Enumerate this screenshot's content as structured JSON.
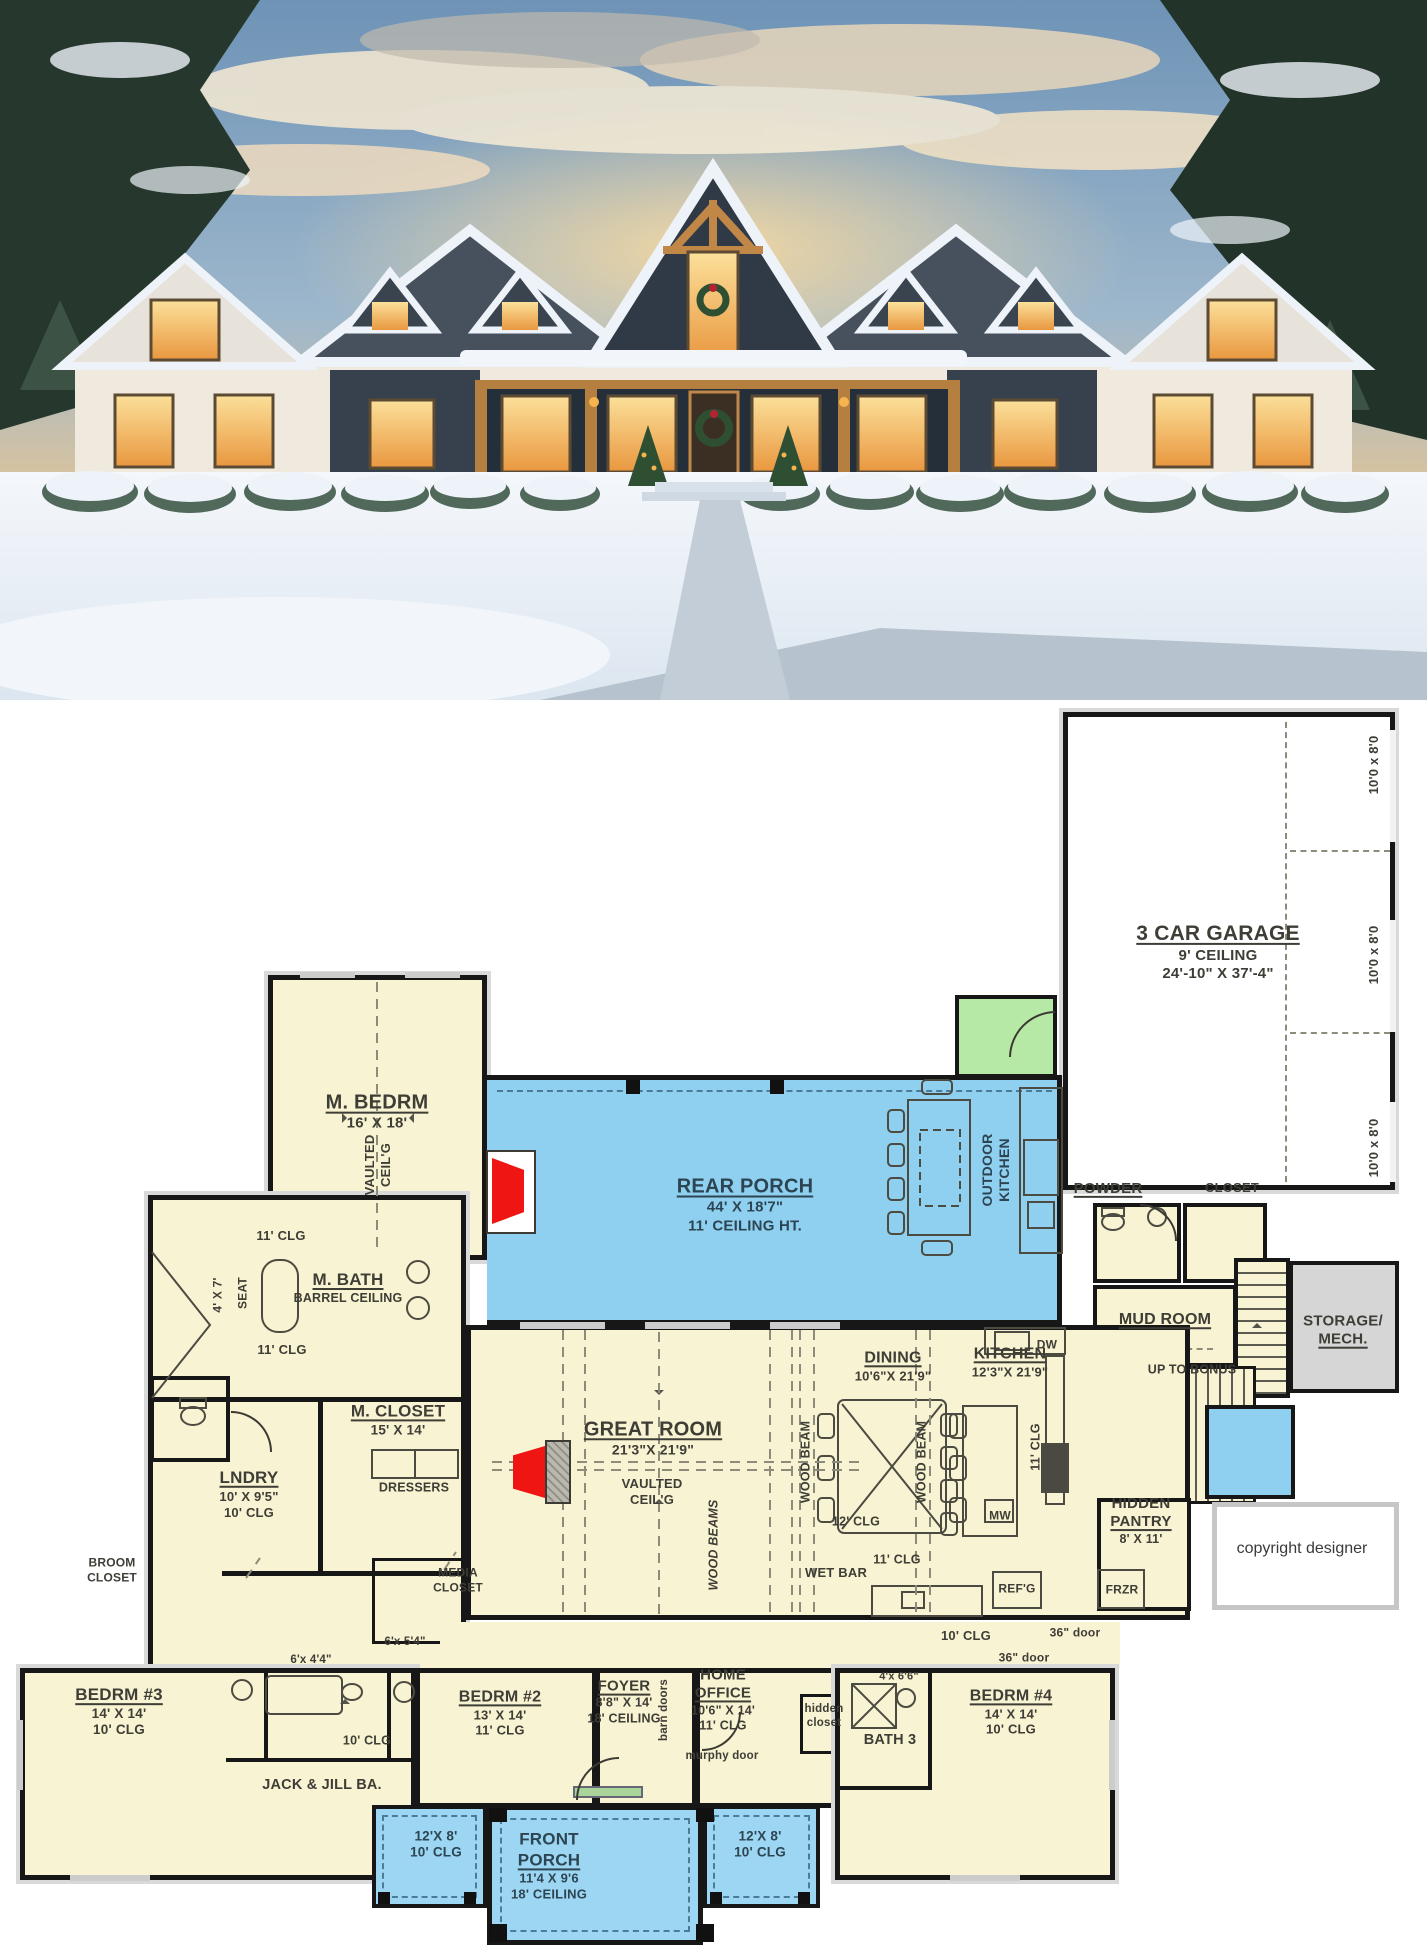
{
  "photo": {
    "description": "Snow-covered modern farmhouse at dusk, warm lit windows, wreaths on door, snowy trees and shrubs",
    "colors": {
      "sky_top": "#6e93b6",
      "sky_glow": "#f0cb90",
      "cloud": "#f6ead2",
      "roof": "#46515d",
      "dark_siding": "#36414d",
      "wall": "#efe9de",
      "timber": "#b5803f",
      "window_glow": "#f6b44e",
      "snow": "#eef3f9",
      "tree": "#26382d",
      "wreath": "#2f4f33",
      "bow": "#b32430"
    }
  },
  "plan": {
    "colors": {
      "room_fill": "#f8f3d2",
      "porch_fill": "#8fd0f1",
      "front_porch_fill": "#9cd6f3",
      "vestibule_green": "#b6e8a6",
      "storage_gray": "#d6d6d6",
      "wall": "#171717",
      "ink": "#3e3d36",
      "porch_ink": "#2d4552",
      "fireplace_red": "#ee1512"
    },
    "labels": [
      {
        "id": "garage-title",
        "x": 1218,
        "y": 952,
        "lines": [
          {
            "t": "3 CAR GARAGE",
            "s": 21,
            "u": 1
          },
          {
            "t": "9' CEILING",
            "s": 15
          },
          {
            "t": "24'-10\" X 37'-4\"",
            "s": 15
          }
        ]
      },
      {
        "id": "garage-door-1",
        "x": 1374,
        "y": 765,
        "rot": -90,
        "lines": [
          {
            "t": "10'0 x 8'0",
            "s": 13
          }
        ]
      },
      {
        "id": "garage-door-2",
        "x": 1374,
        "y": 955,
        "rot": -90,
        "lines": [
          {
            "t": "10'0 x 8'0",
            "s": 13
          }
        ]
      },
      {
        "id": "garage-door-3",
        "x": 1374,
        "y": 1148,
        "rot": -90,
        "lines": [
          {
            "t": "10'0 x 8'0",
            "s": 13
          }
        ]
      },
      {
        "id": "m-bedrm",
        "x": 377,
        "y": 1112,
        "lines": [
          {
            "t": "M. BEDRM",
            "s": 20,
            "u": 1
          },
          {
            "t": "16' X 18'",
            "s": 15
          }
        ]
      },
      {
        "id": "m-bedrm-vaulted",
        "x": 378,
        "y": 1165,
        "rot": -90,
        "lines": [
          {
            "t": "VAULTED",
            "s": 13
          },
          {
            "t": "CEIL'G",
            "s": 13
          }
        ]
      },
      {
        "id": "rear-porch",
        "x": 745,
        "y": 1205,
        "color": "#2d4552",
        "lines": [
          {
            "t": "REAR PORCH",
            "s": 20,
            "u": 1
          },
          {
            "t": "44' X 18'7\"",
            "s": 15
          },
          {
            "t": "11' CEILING HT.",
            "s": 15
          }
        ]
      },
      {
        "id": "outdoor-kitchen",
        "x": 996,
        "y": 1170,
        "rot": -90,
        "color": "#2d4552",
        "lines": [
          {
            "t": "OUTDOOR",
            "s": 14
          },
          {
            "t": "KITCHEN",
            "s": 14
          }
        ]
      },
      {
        "id": "powder",
        "x": 1108,
        "y": 1189,
        "lines": [
          {
            "t": "POWDER",
            "s": 15,
            "u": 1
          }
        ]
      },
      {
        "id": "closet-stairs",
        "x": 1232,
        "y": 1188,
        "lines": [
          {
            "t": "CLOSET",
            "s": 13
          }
        ]
      },
      {
        "id": "mud-room",
        "x": 1165,
        "y": 1320,
        "lines": [
          {
            "t": "MUD ROOM",
            "s": 16,
            "u": 1
          }
        ]
      },
      {
        "id": "up-to-bonus",
        "x": 1192,
        "y": 1370,
        "lines": [
          {
            "t": "UP TO BONUS",
            "s": 12.5
          }
        ]
      },
      {
        "id": "storage-mech",
        "x": 1343,
        "y": 1331,
        "lines": [
          {
            "t": "STORAGE/",
            "s": 15
          },
          {
            "t": "MECH.",
            "s": 15,
            "u": 1
          }
        ]
      },
      {
        "id": "m-bath",
        "x": 348,
        "y": 1288,
        "lines": [
          {
            "t": "M. BATH",
            "s": 17,
            "u": 1
          },
          {
            "t": "BARREL CEILING",
            "s": 12.5
          }
        ]
      },
      {
        "id": "clg-mbath-1",
        "x": 281,
        "y": 1236,
        "lines": [
          {
            "t": "11' CLG",
            "s": 13
          }
        ]
      },
      {
        "id": "clg-mbath-2",
        "x": 282,
        "y": 1350,
        "lines": [
          {
            "t": "11' CLG",
            "s": 13
          }
        ]
      },
      {
        "id": "seat",
        "x": 243,
        "y": 1293,
        "rot": -90,
        "lines": [
          {
            "t": "SEAT",
            "s": 12
          }
        ]
      },
      {
        "id": "dim-4x7",
        "x": 218,
        "y": 1295,
        "rot": -90,
        "lines": [
          {
            "t": "4' X 7'",
            "s": 12
          }
        ]
      },
      {
        "id": "m-closet",
        "x": 398,
        "y": 1420,
        "lines": [
          {
            "t": "M. CLOSET",
            "s": 17,
            "u": 1
          },
          {
            "t": "15' X 14'",
            "s": 13.5
          }
        ]
      },
      {
        "id": "dressers",
        "x": 414,
        "y": 1488,
        "lines": [
          {
            "t": "DRESSERS",
            "s": 12.5
          }
        ]
      },
      {
        "id": "lndry",
        "x": 249,
        "y": 1494,
        "lines": [
          {
            "t": "LNDRY",
            "s": 17,
            "u": 1
          },
          {
            "t": "10' X 9'5\"",
            "s": 13
          },
          {
            "t": "10' CLG",
            "s": 13
          }
        ]
      },
      {
        "id": "broom-closet",
        "x": 112,
        "y": 1570,
        "lines": [
          {
            "t": "BROOM",
            "s": 12
          },
          {
            "t": "CLOSET",
            "s": 12
          }
        ]
      },
      {
        "id": "media-closet",
        "x": 458,
        "y": 1580,
        "lines": [
          {
            "t": "MEDIA",
            "s": 12
          },
          {
            "t": "CLOSET",
            "s": 12
          }
        ]
      },
      {
        "id": "great-room",
        "x": 653,
        "y": 1438,
        "lines": [
          {
            "t": "GREAT ROOM",
            "s": 20,
            "u": 1
          },
          {
            "t": "21'3\"X 21'9\"",
            "s": 14
          }
        ]
      },
      {
        "id": "great-vaulted",
        "x": 652,
        "y": 1492,
        "lines": [
          {
            "t": "VAULTED",
            "s": 13
          },
          {
            "t": "CEIL'G",
            "s": 13
          }
        ]
      },
      {
        "id": "wood-beams",
        "x": 714,
        "y": 1545,
        "rot": -90,
        "italic": 1,
        "lines": [
          {
            "t": "WOOD BEAMS",
            "s": 12.5
          }
        ]
      },
      {
        "id": "wood-beam-l",
        "x": 806,
        "y": 1462,
        "rot": -90,
        "lines": [
          {
            "t": "WOOD BEAM",
            "s": 12.5
          }
        ]
      },
      {
        "id": "wood-beam-r",
        "x": 922,
        "y": 1462,
        "rot": -90,
        "lines": [
          {
            "t": "WOOD BEAM",
            "s": 12.5
          }
        ]
      },
      {
        "id": "dining",
        "x": 893,
        "y": 1366,
        "lines": [
          {
            "t": "DINING",
            "s": 16,
            "u": 1
          },
          {
            "t": "10'6\"X 21'9\"",
            "s": 13
          }
        ]
      },
      {
        "id": "clg-12",
        "x": 856,
        "y": 1522,
        "lines": [
          {
            "t": "12' CLG",
            "s": 12.5
          }
        ]
      },
      {
        "id": "clg-11-dining",
        "x": 897,
        "y": 1560,
        "lines": [
          {
            "t": "11' CLG",
            "s": 12.5
          }
        ]
      },
      {
        "id": "wet-bar",
        "x": 836,
        "y": 1573,
        "lines": [
          {
            "t": "WET BAR",
            "s": 13
          }
        ]
      },
      {
        "id": "kitchen",
        "x": 1010,
        "y": 1362,
        "lines": [
          {
            "t": "KITCHEN",
            "s": 16,
            "u": 1
          },
          {
            "t": "12'3\"X 21'9\"",
            "s": 13
          }
        ]
      },
      {
        "id": "clg-11-kitchen",
        "x": 1036,
        "y": 1447,
        "rot": -90,
        "lines": [
          {
            "t": "11' CLG",
            "s": 12.5
          }
        ]
      },
      {
        "id": "mw",
        "x": 1000,
        "y": 1516,
        "lines": [
          {
            "t": "MW",
            "s": 12
          }
        ]
      },
      {
        "id": "refg",
        "x": 1017,
        "y": 1589,
        "lines": [
          {
            "t": "REF'G",
            "s": 12
          }
        ]
      },
      {
        "id": "dw",
        "x": 1047,
        "y": 1345,
        "lines": [
          {
            "t": "DW",
            "s": 12
          }
        ]
      },
      {
        "id": "hidden-pantry",
        "x": 1141,
        "y": 1521,
        "lines": [
          {
            "t": "HIDDEN",
            "s": 15
          },
          {
            "t": "PANTRY",
            "s": 15,
            "u": 1
          },
          {
            "t": "8' X 11'",
            "s": 12.5
          }
        ]
      },
      {
        "id": "frzr",
        "x": 1122,
        "y": 1590,
        "lines": [
          {
            "t": "FRZR",
            "s": 12
          }
        ]
      },
      {
        "id": "clg-10-hall",
        "x": 966,
        "y": 1636,
        "lines": [
          {
            "t": "10' CLG",
            "s": 13
          }
        ]
      },
      {
        "id": "door36-a",
        "x": 1075,
        "y": 1633,
        "lines": [
          {
            "t": "36\" door",
            "s": 12
          }
        ]
      },
      {
        "id": "door36-b",
        "x": 1024,
        "y": 1658,
        "lines": [
          {
            "t": "36\" door",
            "s": 12
          }
        ]
      },
      {
        "id": "copyright",
        "x": 1302,
        "y": 1549,
        "color": "#3a3a3a",
        "light": 1,
        "lines": [
          {
            "t": "copyright designer",
            "s": 16
          }
        ]
      },
      {
        "id": "bedrm3",
        "x": 119,
        "y": 1712,
        "lines": [
          {
            "t": "BEDRM #3",
            "s": 17,
            "u": 1
          },
          {
            "t": "14' X 14'",
            "s": 13.5
          },
          {
            "t": "10' CLG",
            "s": 13.5
          }
        ]
      },
      {
        "id": "closet-6x44",
        "x": 311,
        "y": 1660,
        "lines": [
          {
            "t": "6'x 4'4\"",
            "s": 11.5
          }
        ]
      },
      {
        "id": "closet-6x54",
        "x": 405,
        "y": 1642,
        "lines": [
          {
            "t": "6'x 5'4\"",
            "s": 11.5
          }
        ]
      },
      {
        "id": "clg-10-jj",
        "x": 367,
        "y": 1741,
        "lines": [
          {
            "t": "10' CLG",
            "s": 12.5
          }
        ]
      },
      {
        "id": "jack-jill",
        "x": 322,
        "y": 1786,
        "lines": [
          {
            "t": "JACK & JILL BA.",
            "s": 14.5
          }
        ]
      },
      {
        "id": "bedrm2",
        "x": 500,
        "y": 1713,
        "lines": [
          {
            "t": "BEDRM #2",
            "s": 16,
            "u": 1
          },
          {
            "t": "13' X 14'",
            "s": 13
          },
          {
            "t": "11' CLG",
            "s": 13
          }
        ]
      },
      {
        "id": "foyer",
        "x": 624,
        "y": 1702,
        "lines": [
          {
            "t": "FOYER",
            "s": 15,
            "u": 1
          },
          {
            "t": "8'8\" X 14'",
            "s": 12.5
          },
          {
            "t": "18' CEILING",
            "s": 12.5
          }
        ]
      },
      {
        "id": "barn-doors",
        "x": 664,
        "y": 1710,
        "rot": -90,
        "lines": [
          {
            "t": "barn doors",
            "s": 11.5
          }
        ]
      },
      {
        "id": "home-office",
        "x": 723,
        "y": 1700,
        "lines": [
          {
            "t": "HOME",
            "s": 15
          },
          {
            "t": "OFFICE",
            "s": 15,
            "u": 1
          },
          {
            "t": "10'6\" X 14'",
            "s": 12.5
          },
          {
            "t": "11' CLG",
            "s": 12.5
          }
        ]
      },
      {
        "id": "murphy-door",
        "x": 722,
        "y": 1756,
        "lines": [
          {
            "t": "murphy door",
            "s": 11.5
          }
        ]
      },
      {
        "id": "hidden-closet",
        "x": 824,
        "y": 1716,
        "lines": [
          {
            "t": "hidden",
            "s": 11.5
          },
          {
            "t": "closet",
            "s": 11.5
          }
        ]
      },
      {
        "id": "bath3",
        "x": 890,
        "y": 1741,
        "lines": [
          {
            "t": "BATH 3",
            "s": 14.5
          }
        ]
      },
      {
        "id": "closet-4x66",
        "x": 899,
        "y": 1677,
        "lines": [
          {
            "t": "4'x 6'6\"",
            "s": 11
          }
        ]
      },
      {
        "id": "bedrm4",
        "x": 1011,
        "y": 1712,
        "lines": [
          {
            "t": "BEDRM #4",
            "s": 16,
            "u": 1
          },
          {
            "t": "14' X 14'",
            "s": 13
          },
          {
            "t": "10' CLG",
            "s": 13
          }
        ]
      },
      {
        "id": "porch-left-dim",
        "x": 436,
        "y": 1845,
        "color": "#2d4552",
        "lines": [
          {
            "t": "12'X 8'",
            "s": 13.5
          },
          {
            "t": "10' CLG",
            "s": 13.5
          }
        ]
      },
      {
        "id": "front-porch",
        "x": 549,
        "y": 1866,
        "color": "#2d4552",
        "lines": [
          {
            "t": "FRONT",
            "s": 17
          },
          {
            "t": "PORCH",
            "s": 17,
            "u": 1
          },
          {
            "t": "11'4 X 9'6",
            "s": 13
          },
          {
            "t": "18' CEILING",
            "s": 13
          }
        ]
      },
      {
        "id": "porch-right-dim",
        "x": 760,
        "y": 1845,
        "color": "#2d4552",
        "lines": [
          {
            "t": "12'X 8'",
            "s": 13.5
          },
          {
            "t": "10' CLG",
            "s": 13.5
          }
        ]
      }
    ]
  }
}
